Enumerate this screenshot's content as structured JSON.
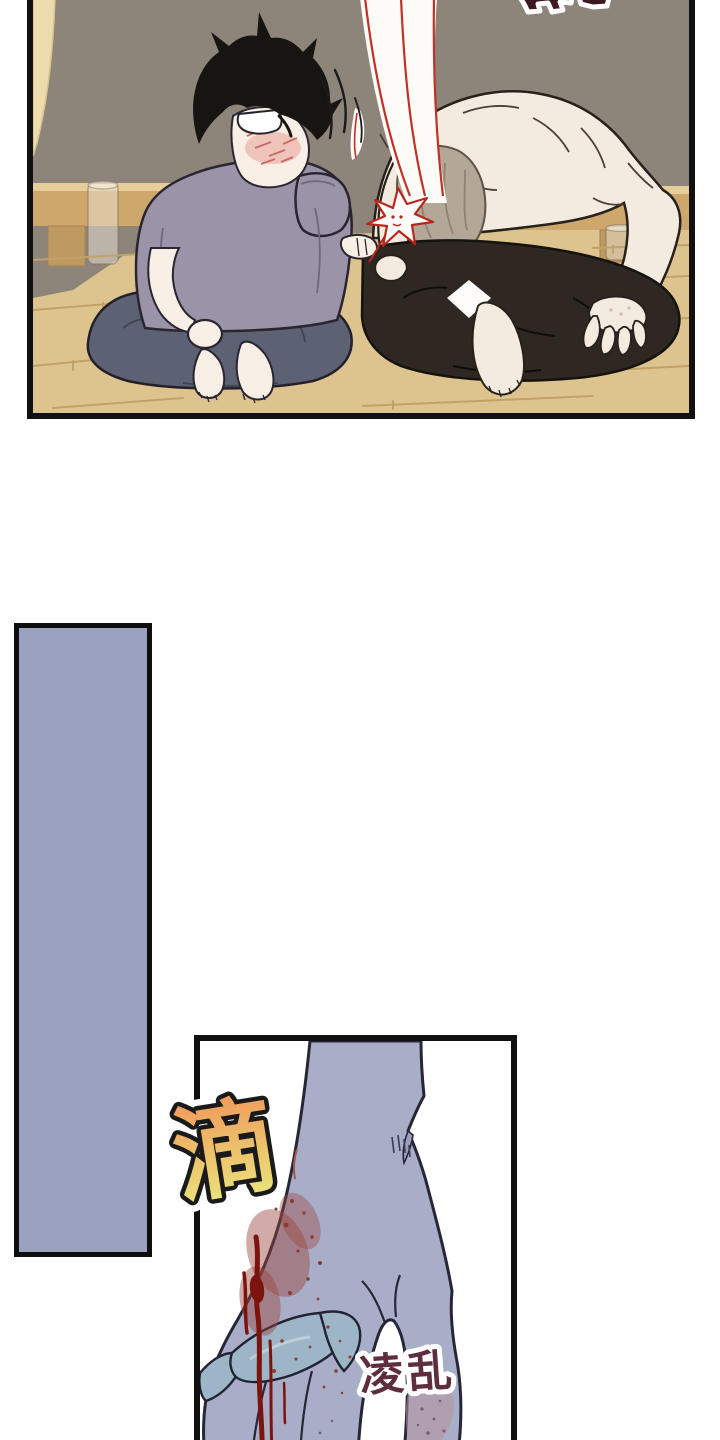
{
  "page": {
    "kind": "manhwa-comic-page",
    "background": "#ffffff",
    "width": 720,
    "height": 1440
  },
  "top_panel": {
    "scene": "two men sitting cross-legged on a wooden floor; left man black-haired and blushing, right man shirtless bent over with a blood fountain spraying up from his nose",
    "border_color": "#111111",
    "wall_color": "#8d857a",
    "floor_color": "#ddc48e",
    "floor_seam_color": "#c2a167",
    "bench_color": "#cda76b",
    "bench_top_color": "#e6cd99",
    "bench_leg_color": "#bf9a60",
    "curtain_color": "#ecdcab",
    "left_character": {
      "hair_color": "#171412",
      "skin_color": "#f7efe5",
      "shirt_color": "#9b94a9",
      "pants_color": "#5c6173",
      "blush_color": "#d4706a",
      "glasses_color": "#ffffff"
    },
    "right_character": {
      "skin_color": "#f4ebe0",
      "hair_color": "#b3a897",
      "pants_color": "#2f2822",
      "blood_color": "#c03226",
      "burst_fill": "#fdfcfa"
    },
    "sfx_cutoff_color": "#3d1a22",
    "sfx_cutoff_outline": "#ffffff"
  },
  "spacer_panel": {
    "fill_color": "#9aa2c0",
    "border_color": "#0e0e0e"
  },
  "bottom_panel": {
    "scene": "close-up of a bloodied hand hanging down, holding a blue cloth strap",
    "border_color": "#111111",
    "background": "#ffffff",
    "hand_color": "#a9aec8",
    "outline_color": "#262637",
    "strap_color": "#9cb6c8",
    "strap_highlight": "#c3d4de",
    "blood_streak_color": "#7c130c",
    "blood_smudge_color": "#9a453c",
    "bruise_color": "#b5939f"
  },
  "sfx": {
    "drip": {
      "text": "滴",
      "gradient_top": "#f09a5a",
      "gradient_bottom": "#eae97f",
      "outline_inner": "#1a1a1a",
      "outline_outer": "#ffffff"
    },
    "messy": {
      "text": "凌乱",
      "color": "#5e2e3e",
      "outline": "#ffffff"
    }
  }
}
